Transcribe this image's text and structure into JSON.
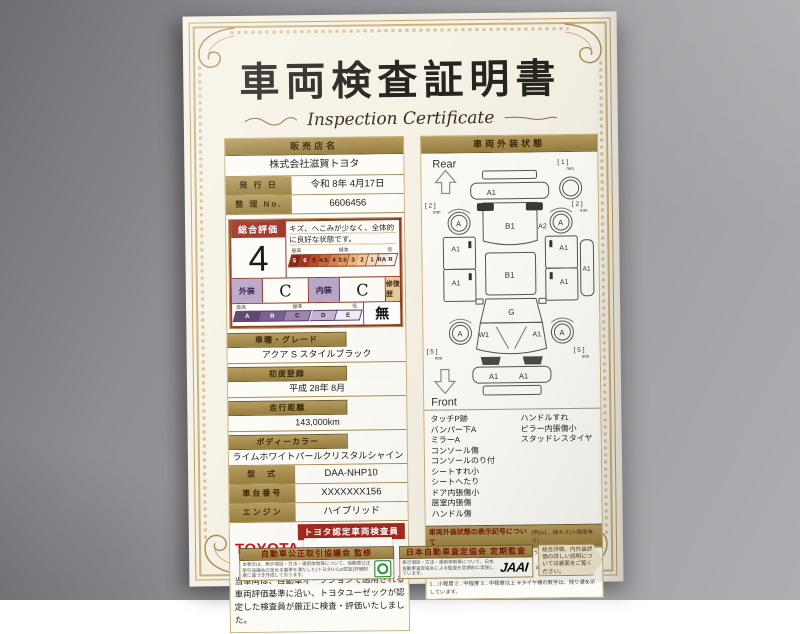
{
  "page": {
    "title": "車両検査証明書",
    "subtitle": "Inspection Certificate"
  },
  "seller": {
    "header": "販売店名",
    "name": "株式会社滋賀トヨタ",
    "issue_label": "発 行 日",
    "issue_value": "令和 8年 4月17日",
    "refno_label": "整 理 No.",
    "refno_value": "6606456"
  },
  "rating": {
    "label": "総合評価",
    "score": "4",
    "comment": "キズ、へこみが少なく、全体的に良好な状態です。",
    "scale_best": "最高",
    "scale_std": "標準",
    "scale_low": "低",
    "scale": [
      "S",
      "6",
      "5",
      "4.5",
      "4",
      "3.5",
      "3",
      "2",
      "1",
      "RA",
      "R"
    ],
    "exterior_label": "外装",
    "exterior_grade": "C",
    "interior_label": "内装",
    "interior_grade": "C",
    "repair_label": "修復歴",
    "repair_value": "無",
    "grades": [
      "A",
      "B",
      "C",
      "D",
      "E"
    ]
  },
  "fields": [
    {
      "label": "車種・グレード",
      "value": "アクア S スタイルブラック"
    },
    {
      "label": "初度登録",
      "value": "平成 28年 8月"
    },
    {
      "label": "走行距離",
      "value": "143,000km"
    },
    {
      "label": "ボディーカラー",
      "value": "ライムホワイトパールクリスタルシャイン"
    },
    {
      "label": "型　式",
      "value": "DAA-NHP10"
    },
    {
      "label": "車台番号",
      "value": "XXXXXXX156"
    },
    {
      "label": "エンジン",
      "value": "ハイブリッド"
    }
  ],
  "toyota": {
    "logo": "TOYOTA",
    "badge": "トヨタ認定車両検査員"
  },
  "note": "当車両は、自動車オークションで適用される車両評価基準に沿い、トヨタユーゼックが認定した検査員が厳正に検査・評価いたしました。",
  "exterior": {
    "header": "車両外装状態",
    "rear": "Rear",
    "front": "Front",
    "marks": {
      "spare_tread": "[ 1 ]",
      "unit": "mm",
      "rear_bumper": "A1",
      "hatch": "B1",
      "roof": "B1",
      "windshield": "G",
      "wheel": "A",
      "rear_tread": "[ 2 ]",
      "front_tread": "[ 5 ]",
      "door": "A1",
      "right_rear": "A2",
      "left_front": "W1",
      "right_front": "A1",
      "sill": "A1",
      "front_bumper_left": "A1",
      "front_bumper_right": "A1"
    },
    "conditions_left": [
      "タッチP跡",
      "バンパー下A",
      "ミラーA",
      "コンソール傷",
      "コンソールのり付",
      "シートすれ小",
      "シートへたり",
      "ドア内張傷小",
      "居室内張傷",
      "ハンドル傷"
    ],
    "conditions_right": [
      "ハンドルすれ",
      "ピラー内張傷小",
      "スタッドレスタイヤ"
    ],
    "legend_title": "車両外装状態の表示記号について",
    "legend_example": "(例)A1…線キズ(小程度有り)",
    "legend_lines": [
      "A…線キズ有り  U…ヘコミ有り  B…キズを伴うヘコミ有り  P…要塗装  W…一般修理有り  S…サビ有り",
      "C…腐食有り  G…フロントガラス点キズ有り  X…要交換(裏面に明記あり)  XX…交換歴有り",
      "1…小程度  2…中程度  3…中程度以上  ※タイヤ横の数字は、残り溝を示しています。"
    ]
  },
  "footer": {
    "fair_trade_title": "自動車公正取引協議会 監修",
    "fair_trade_text": "本表示は、表示項目・方法・運用体制等について、自動車公正取引協議会の定める基準を満たした(トヨタU-Car認定)評価制度に基づき作成しております。",
    "jaai_title": "日本自動車査定協会 定期監査",
    "jaai_text": "表示項目・方法・運用体制等について、日本自動車査定協会による監査を定期的に実施しています。",
    "jaai_logo": "JAAI",
    "back_note": "総合評価、内外装評価の詳しい説明については裏面をご覧ください。"
  }
}
